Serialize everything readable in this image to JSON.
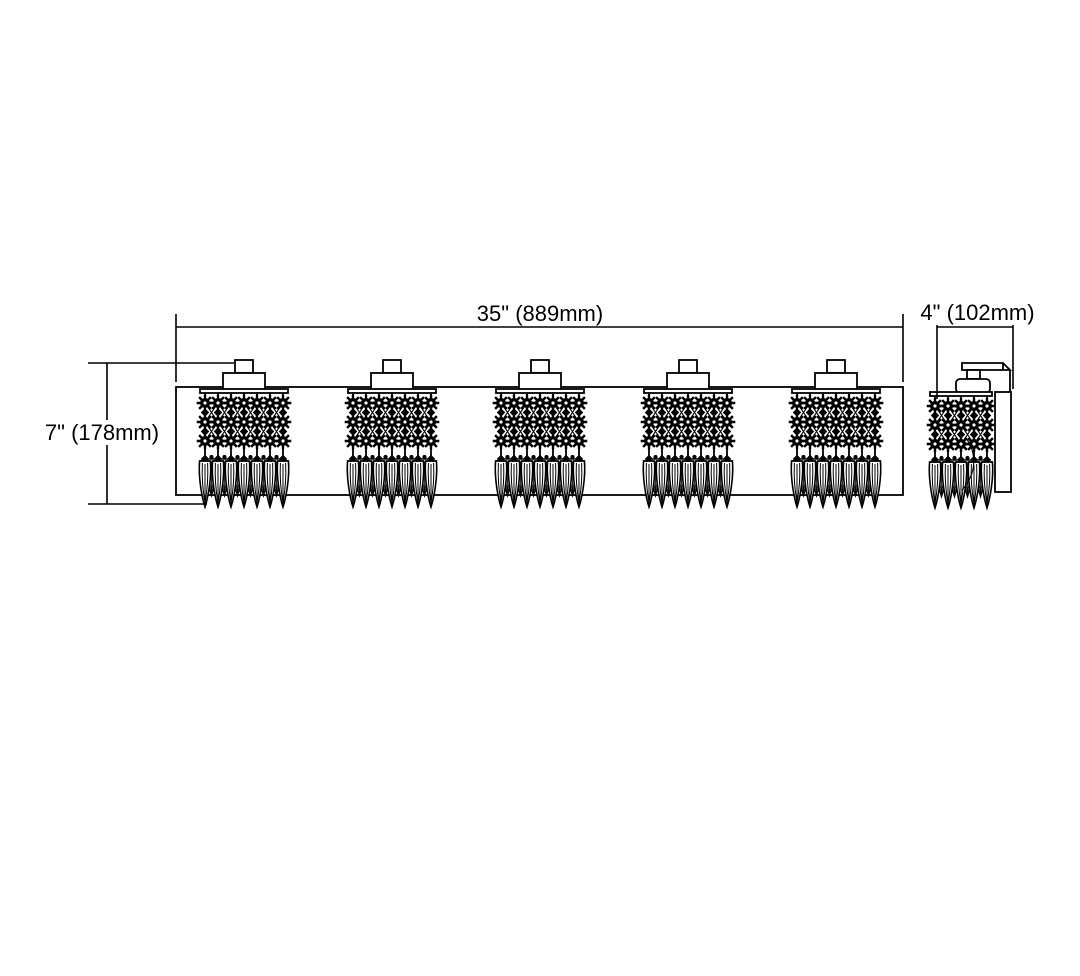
{
  "meta": {
    "background_color": "#ffffff",
    "line_color": "#000000"
  },
  "labels": {
    "width": "35\" (889mm)",
    "height": "7\" (178mm)",
    "depth": "4\" (102mm)"
  },
  "fixture": {
    "front_view": {
      "light_count": 5
    },
    "side_view": {
      "light_count": 1
    }
  }
}
